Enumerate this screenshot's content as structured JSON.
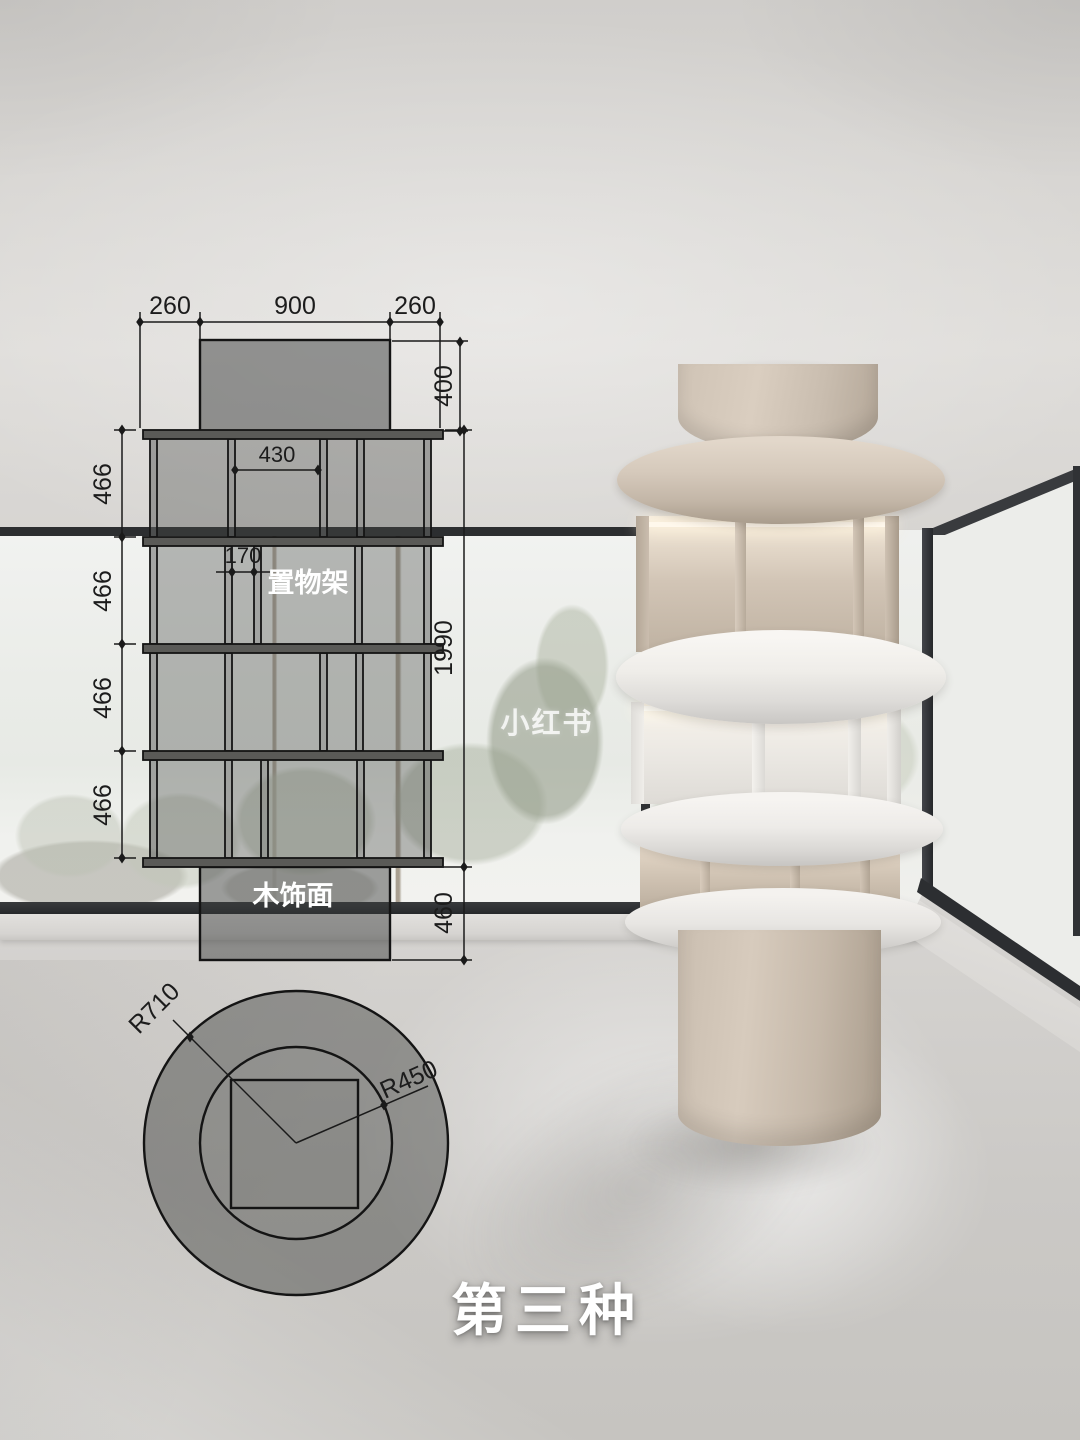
{
  "scene": {
    "title": "第三种",
    "watermark": "小红书"
  },
  "elevation": {
    "labels": {
      "shelf": "置物架",
      "veneer": "木饰面"
    },
    "dims": {
      "left_margin": "260",
      "top_width": "900",
      "right_margin": "260",
      "top_height": "400",
      "opening": "430",
      "slot": "170",
      "rows": [
        "466",
        "466",
        "466",
        "466"
      ],
      "total": "1990",
      "base": "460"
    }
  },
  "plan": {
    "outer": "R710",
    "inner": "R450"
  },
  "colors": {
    "drawing_line": "#141414",
    "label_text": "#ffffff",
    "wood_accent": "#cdc1b3",
    "white_shelf": "#f1efec",
    "window_frame": "#2d2f31",
    "floor": "#cfcdca"
  }
}
